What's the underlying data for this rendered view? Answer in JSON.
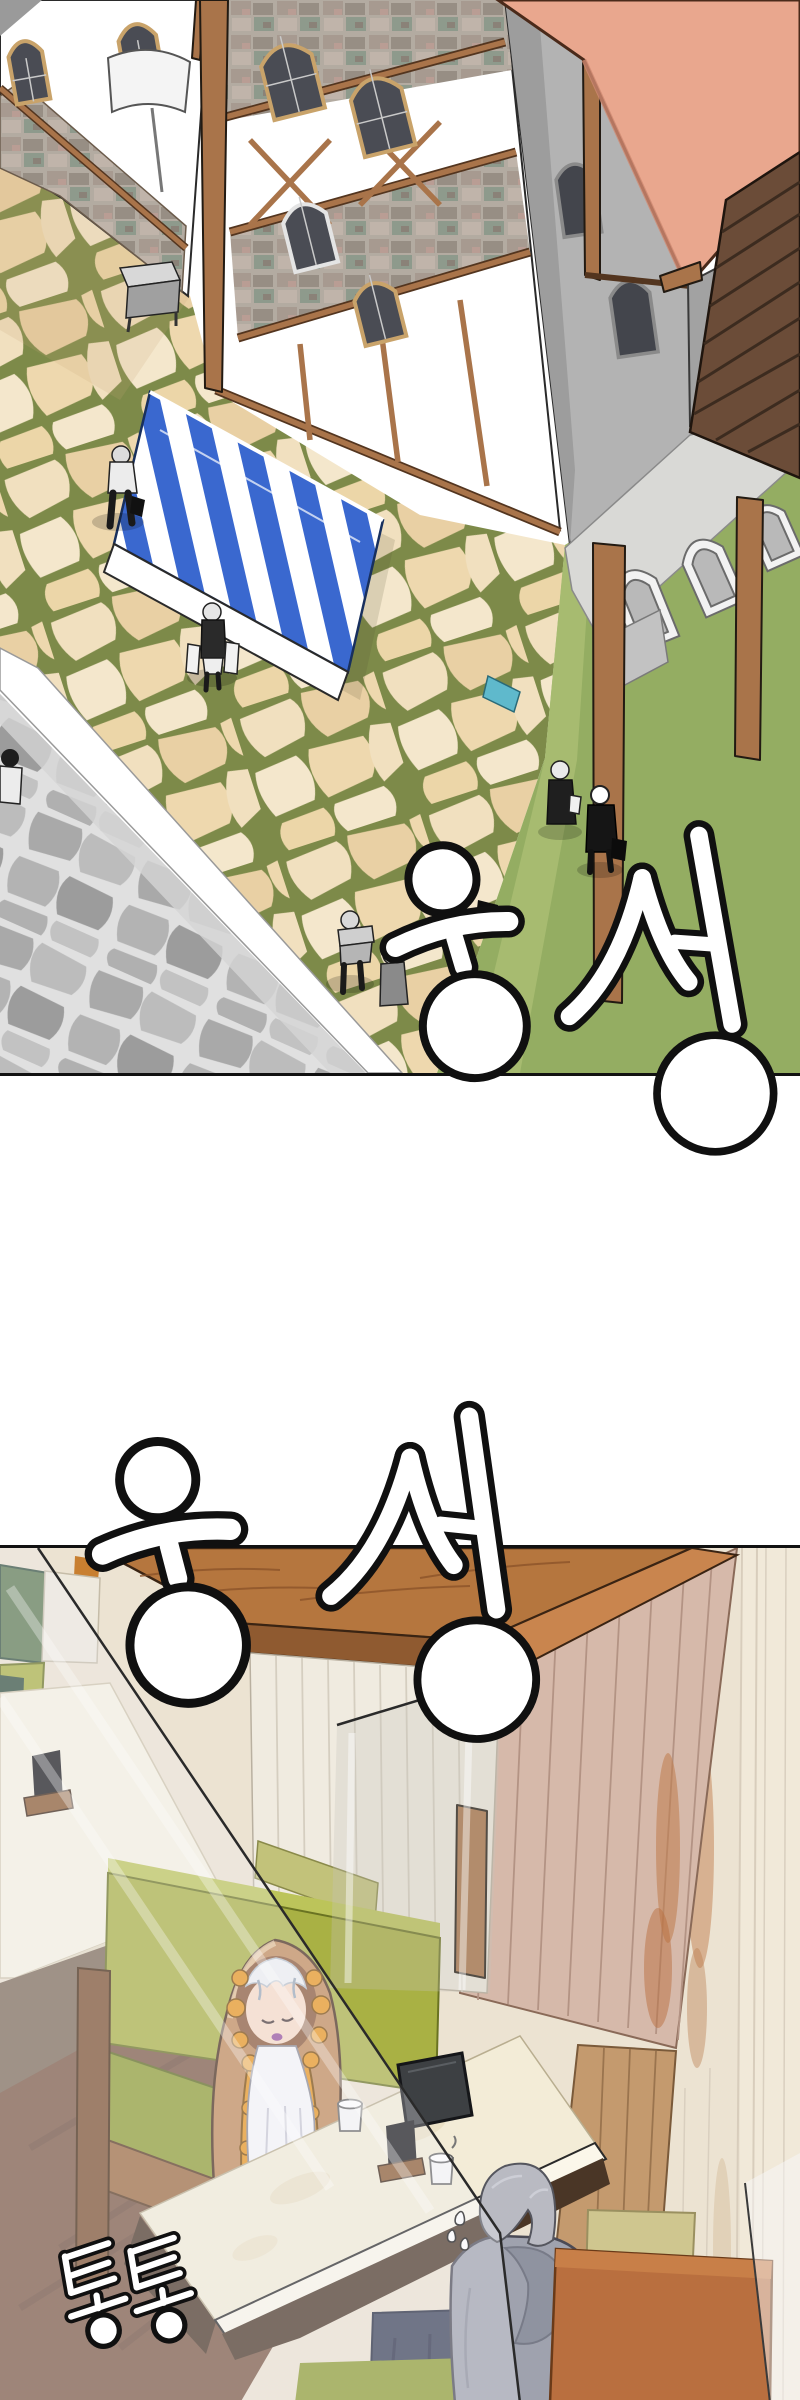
{
  "sfx": {
    "murmur1": "웅성",
    "murmur2": "웅성",
    "tap": "통통"
  },
  "palette": {
    "roof-salmon": "#e9a78e",
    "awning-blue": "#3a68cf",
    "timber-brown": "#a9744a",
    "street-stone": "#f0ddbb",
    "street-mortar": "#7d8a49",
    "lawn-green": "#94ad62",
    "wall-gray": "#b0b0b0",
    "plaster-white": "#ffffff",
    "interior-wood": "#b5763e",
    "plank-pink": "#d6b9aa",
    "plank-cream": "#ece3d2",
    "booth-green": "#a9b144",
    "seat-green": "#8f9c33",
    "table-cream": "#f3ecd7",
    "floor-brown": "#7b5844",
    "booth-orange": "#b96f3f",
    "hood-tan": "#c08a5a",
    "hood-gold": "#e8951f",
    "hoodie-gray": "#9fa2ae",
    "pants-navy": "#3a4158",
    "sfx-ink": "#101010",
    "sfx-fill": "#ffffff"
  }
}
